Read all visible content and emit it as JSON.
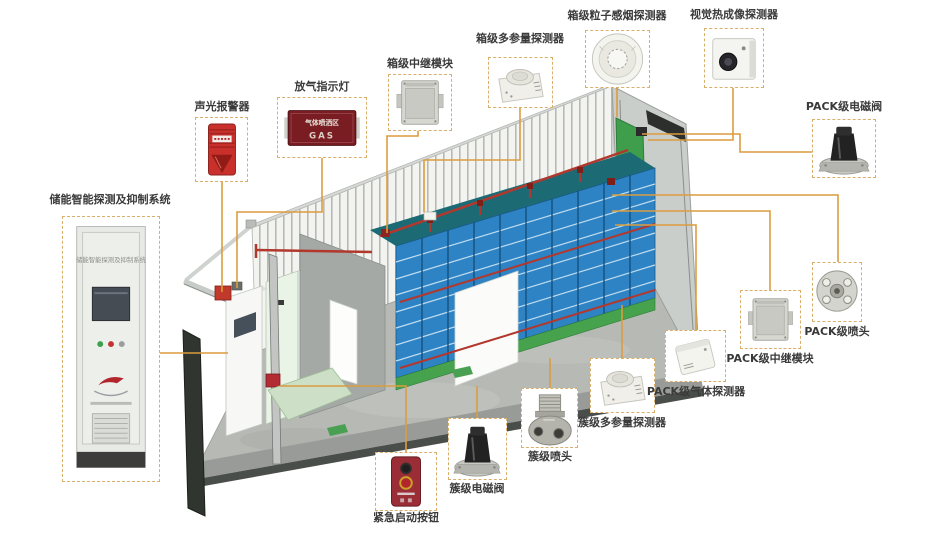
{
  "diagram_type": "battery-energy-storage-container-fire-safety-system",
  "colors": {
    "background": "#FFFFFF",
    "connector_line": "#DC9C3F",
    "callout_border": "#D9AF6B",
    "label_text": "#3A3A3A",
    "rack_blue": "#2E83C4",
    "rack_base_green": "#46A24C",
    "pipe_red": "#B2382E",
    "end_door_green": "#3E9E4B",
    "alarm_red": "#C62F2A",
    "sign_dark_red": "#7A1D22"
  },
  "devices": {
    "gas_sign": {
      "line1": "气体喷洒区",
      "line2": "GAS"
    },
    "cabinet_panel_text": "储能智能探测及抑制系统"
  },
  "callouts": [
    {
      "id": "storage-system",
      "label": "储能智能探测及抑制系统"
    },
    {
      "id": "sound-light-alarm",
      "label": "声光报警器"
    },
    {
      "id": "gas-release-indicator",
      "label": "放气指示灯"
    },
    {
      "id": "box-relay-module",
      "label": "箱级中继模块"
    },
    {
      "id": "box-multiparam-detector",
      "label": "箱级多参量探测器"
    },
    {
      "id": "box-smoke-detector",
      "label": "箱级粒子感烟探测器"
    },
    {
      "id": "thermal-imaging-detector",
      "label": "视觉热成像探测器"
    },
    {
      "id": "pack-solenoid-valve",
      "label": "PACK级电磁阀"
    },
    {
      "id": "pack-nozzle",
      "label": "PACK级喷头"
    },
    {
      "id": "pack-relay-module",
      "label": "PACK级中继模块"
    },
    {
      "id": "pack-gas-detector",
      "label": "PACK级气体探测器"
    },
    {
      "id": "cluster-multiparam-detector",
      "label": "簇级多参量探测器"
    },
    {
      "id": "cluster-nozzle",
      "label": "簇级喷头"
    },
    {
      "id": "cluster-solenoid-valve",
      "label": "簇级电磁阀"
    },
    {
      "id": "emergency-start-button",
      "label": "紧急启动按钮"
    }
  ]
}
